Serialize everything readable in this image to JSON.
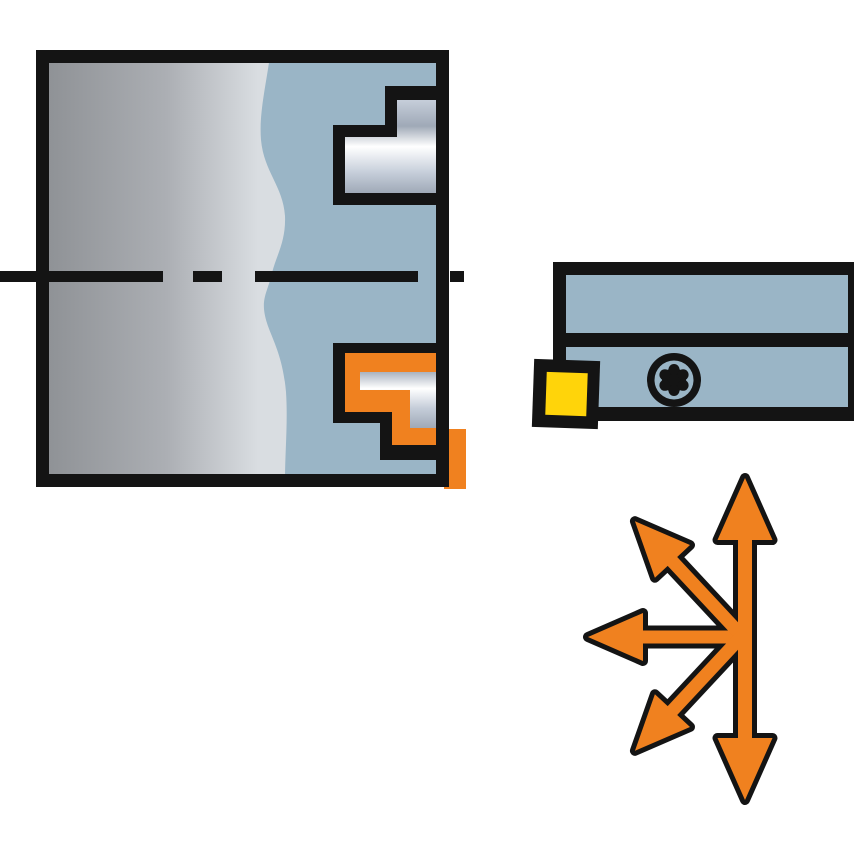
{
  "figure": {
    "type": "technical-illustration",
    "subject": "profiling-turning-tool-application",
    "description": "Internal profile machining: workpiece bore with machined steps, turning tool holder with indexable insert and torx clamp screw, multi-directional feed arrows",
    "parts": {
      "workpiece": "grey workpiece cross-section",
      "bore_profile": "blue machined bore region with stepped metal profiles",
      "upper_step": "machined step (metal)",
      "lower_step": "cutting tool step (orange) with metal insert path",
      "tool_holder": "blue turning tool holder bar",
      "cutting_insert": "yellow indexable insert",
      "insert_pocket": "black insert pocket",
      "torx_screw": "torx clamp screw",
      "centerline": "dashed rotation centerline",
      "direction_arrows": "orange multi-directional feed arrows"
    },
    "arrow_directions": [
      "up",
      "up-left",
      "left",
      "down-left",
      "down"
    ]
  },
  "colors": {
    "background": "#FFFFFF",
    "outline": "#141414",
    "tool_blue": "#9AB5C6",
    "orange": "#F0811F",
    "insert_yellow": "#FFD40A",
    "workpiece_dark": "#8F9296",
    "workpiece_mid": "#ACAFB4",
    "workpiece_light": "#D9DDE1",
    "metal_dark": "#9FA9B7",
    "metal_mid": "#C6CEDA",
    "metal_light": "#FFFFFF"
  }
}
